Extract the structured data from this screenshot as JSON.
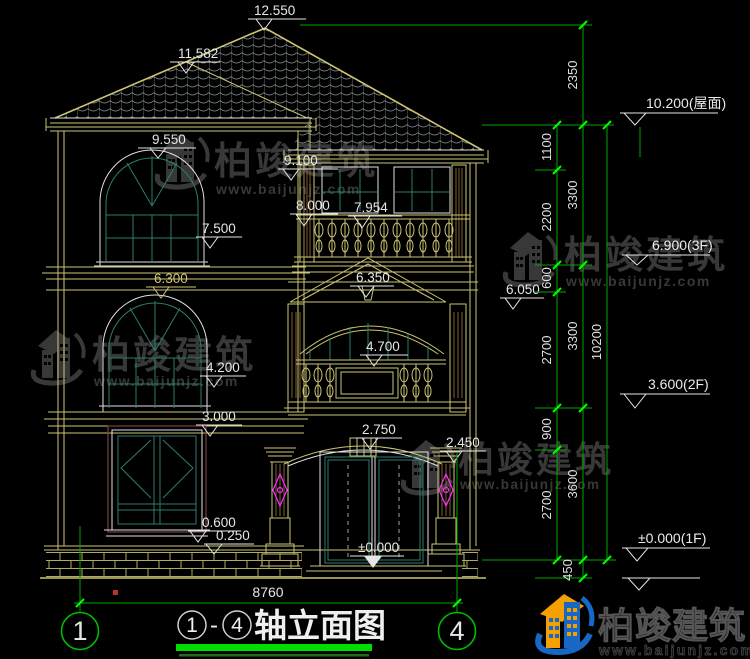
{
  "drawing": {
    "labels": {
      "l12550": "12.550",
      "l11582": "11.582",
      "l9550": "9.550",
      "l9100": "9.100",
      "l8000": "8.000",
      "l7954": "7.954",
      "l7500": "7.500",
      "l6300": "6.300",
      "l6350": "6.350",
      "l6050": "6.050",
      "l4700": "4.700",
      "l4200": "4.200",
      "l3000": "3.000",
      "l2750": "2.750",
      "l2450": "2.450",
      "l0600": "0.600",
      "l0250": "0.250",
      "lzero": "±0.000",
      "width_total": "8760"
    },
    "vdims": {
      "v2350": "2350",
      "v1100": "1100",
      "v2200": "2200",
      "v600": "600",
      "v2700a": "2700",
      "v900": "900",
      "v2700b": "2700",
      "v450": "450",
      "v3300a": "3300",
      "v3300b": "3300",
      "v3600": "3600",
      "v10200": "10200"
    },
    "level_markers": {
      "roof": "10.200(屋面)",
      "f3": "6.900(3F)",
      "f2": "3.600(2F)",
      "f1": "±0.000(1F)"
    },
    "axes": {
      "left": "1",
      "right": "4"
    }
  },
  "title_bar": {
    "axis_a": "1",
    "dash": "-",
    "axis_b": "4",
    "name": "轴立面图"
  },
  "watermark": {
    "name": "柏竣建筑",
    "url": "www.baijunjz.com"
  },
  "logo": {
    "name": "柏竣建筑",
    "url": "www.baijunjz.com"
  },
  "colors": {
    "background": "#000000",
    "house_yellow": "#cdc472",
    "dim_green": "#00a800",
    "tick_green": "#00ff00",
    "text_white": "#e6e6e6",
    "window_teal": "#2e7d6c",
    "ornament_magenta": "#ff2bff",
    "watermark_gray": "#383838",
    "logo_blue": "#1668c4",
    "logo_orange": "#f6a000",
    "underline_green": "#00dd00"
  }
}
